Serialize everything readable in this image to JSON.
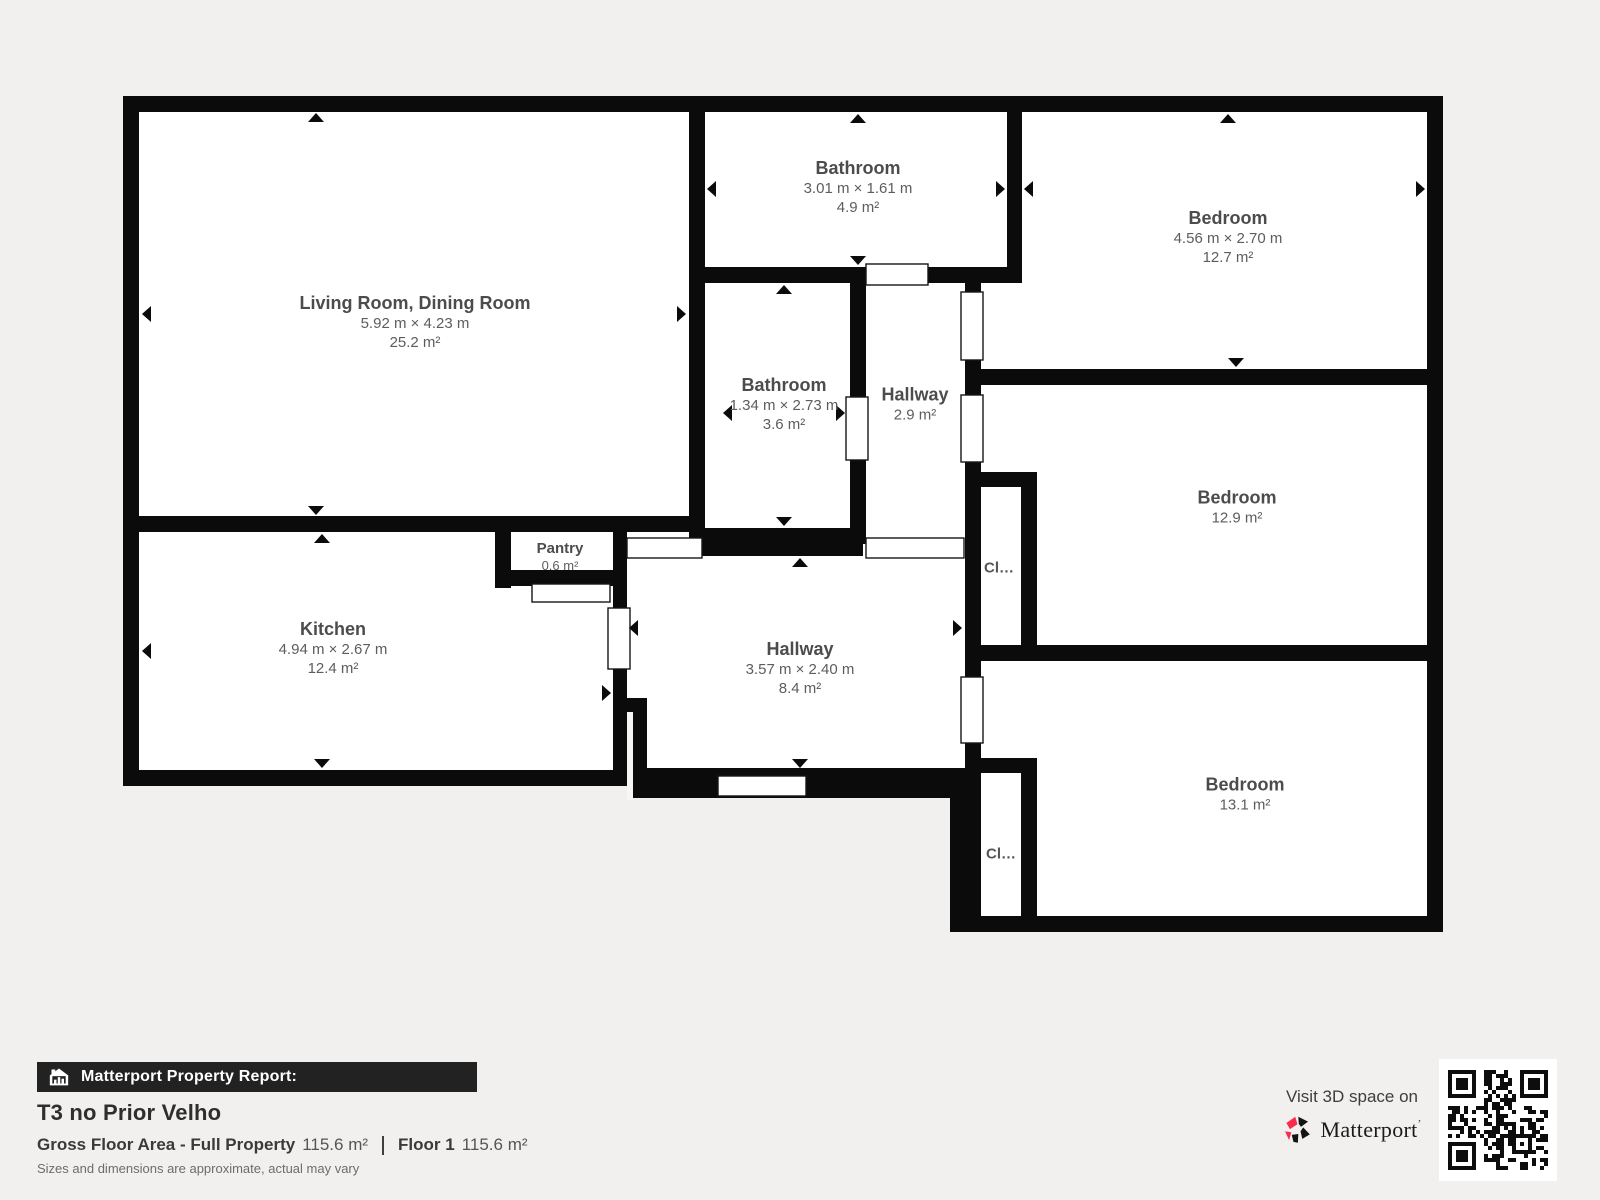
{
  "page": {
    "background": "#f1f0ee",
    "wall_color": "#0b0b0b",
    "room_fill": "#ffffff"
  },
  "floor_plan": {
    "rooms": [
      {
        "id": "living-room",
        "name": "Living Room, Dining Room",
        "dimensions": "5.92 m × 4.23 m",
        "area": "25.2 m²"
      },
      {
        "id": "kitchen",
        "name": "Kitchen",
        "dimensions": "4.94 m × 2.67 m",
        "area": "12.4 m²"
      },
      {
        "id": "pantry",
        "name": "Pantry",
        "area": "0.6 m²"
      },
      {
        "id": "bathroom-top",
        "name": "Bathroom",
        "dimensions": "3.01 m × 1.61 m",
        "area": "4.9 m²"
      },
      {
        "id": "bedroom-top-right",
        "name": "Bedroom",
        "dimensions": "4.56 m × 2.70 m",
        "area": "12.7 m²"
      },
      {
        "id": "bathroom-middle",
        "name": "Bathroom",
        "dimensions": "1.34 m × 2.73 m",
        "area": "3.6 m²"
      },
      {
        "id": "hallway-small",
        "name": "Hallway",
        "area": "2.9 m²"
      },
      {
        "id": "hallway-main",
        "name": "Hallway",
        "dimensions": "3.57 m × 2.40 m",
        "area": "8.4 m²"
      },
      {
        "id": "bedroom-middle-right",
        "name": "Bedroom",
        "area": "12.9 m²"
      },
      {
        "id": "bedroom-bottom-right",
        "name": "Bedroom",
        "area": "13.1 m²"
      },
      {
        "id": "closet-1",
        "name": "Cl…"
      },
      {
        "id": "closet-2",
        "name": "Cl…"
      }
    ]
  },
  "report": {
    "bar_label": "Matterport Property Report:",
    "title": "T3 no Prior Velho",
    "gross_label": "Gross Floor Area - Full Property",
    "gross_value": "115.6 m²",
    "floor_label": "Floor 1",
    "floor_value": "115.6 m²",
    "disclaimer": "Sizes and dimensions are approximate, actual may vary"
  },
  "promo": {
    "visit_text": "Visit 3D space on",
    "brand": "Matterport",
    "brand_mark": "ʼ",
    "brand_red": "#fb2b50",
    "brand_black": "#141414"
  }
}
